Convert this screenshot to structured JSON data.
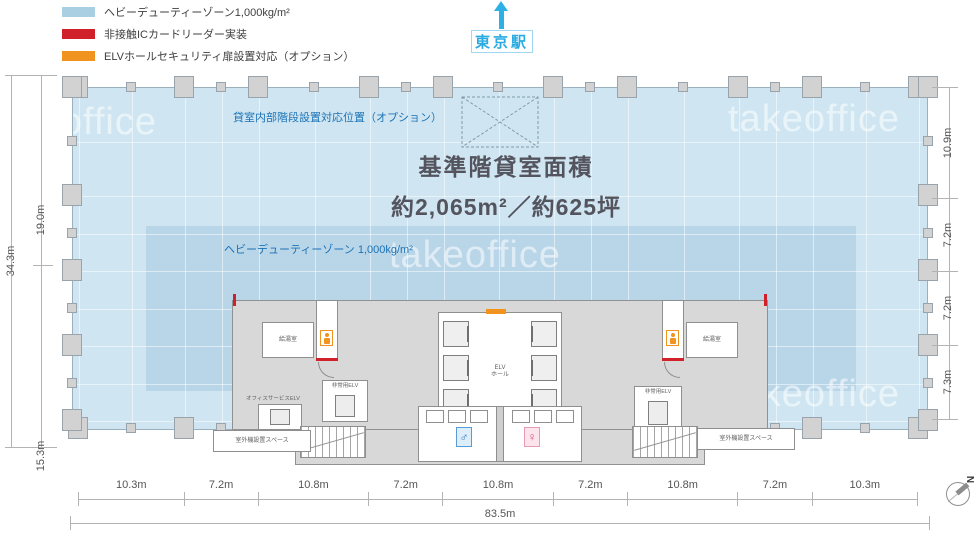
{
  "legend": {
    "items": [
      {
        "label": "ヘビーデューティーゾーン1,000kg/m²",
        "color": "#a9cfe3"
      },
      {
        "label": "非接触ICカードリーダー実装",
        "color": "#d0202a"
      },
      {
        "label": "ELVホールセキュリティ扉設置対応（オプション）",
        "color": "#f0931f"
      }
    ]
  },
  "station": {
    "label": "東京駅",
    "arrow_color": "#2fb0e4"
  },
  "plan": {
    "title_line1": "基準階貸室面積",
    "title_line2": "約2,065m²／約625坪",
    "stair_option_label": "貸室内部階段設置対応位置（オプション）",
    "heavy_duty_zone_label": "ヘビーデューティーゾーン 1,000kg/m²",
    "floor_color": "#cfe6f2",
    "heavy_duty_zone_color": "#b9d6e8",
    "elv_hall_label": "ELV\nホール",
    "kitchenette_label_left": "給湯室",
    "kitchenette_label_right": "給湯室",
    "office_service_elv_label": "オフィスサービスELV",
    "emergency_elv_label_left": "非常用ELV",
    "emergency_elv_label_right": "非常用ELV",
    "outdoor_unit_label_left": "室外機設置スペース",
    "outdoor_unit_label_right": "室外機設置スペース",
    "male_symbol": "♂",
    "female_symbol": "♀"
  },
  "dimensions": {
    "left_total": "34.3m",
    "left_segments": [
      "19.0m",
      "15.3m"
    ],
    "right_segments": [
      "10.9m",
      "7.2m",
      "7.2m",
      "7.3m"
    ],
    "bottom_segments": [
      "10.3m",
      "7.2m",
      "10.8m",
      "7.2m",
      "10.8m",
      "7.2m",
      "10.8m",
      "7.2m",
      "10.3m"
    ],
    "bottom_total": "83.5m"
  },
  "watermark": "takeoffice",
  "compass_label": "N"
}
